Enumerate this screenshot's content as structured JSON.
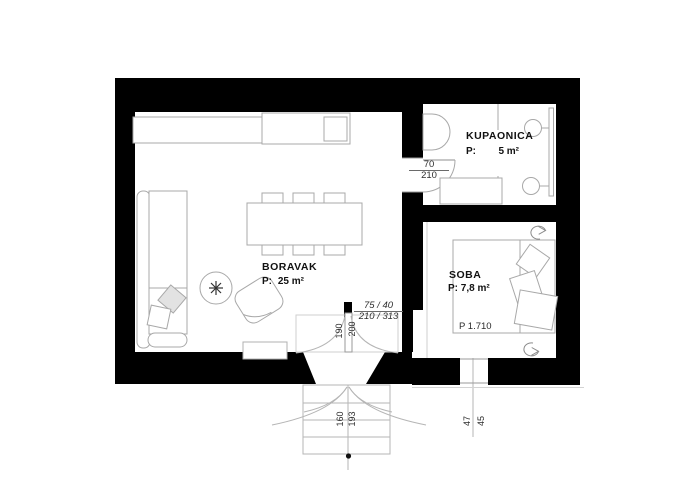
{
  "rooms": {
    "boravak": {
      "name": "BORAVAK",
      "p": "P:",
      "area": "25 m²"
    },
    "kupaonica": {
      "name": "KUPAONICA",
      "p": "P:",
      "area": "5 m²"
    },
    "soba": {
      "name": "SOBA",
      "area_line": "P: 7,8 m²",
      "bed_note": "P 1.710"
    }
  },
  "dims": {
    "bath_door": {
      "top": "70",
      "bottom": "210"
    },
    "entry": {
      "top": "75 / 40",
      "bottom": "210 / 313"
    },
    "door_leaves": {
      "left": "190",
      "right": "200"
    },
    "porch": {
      "left": "160",
      "right": "193"
    },
    "window": {
      "left": "47",
      "right": "45"
    }
  },
  "colors": {
    "wall": "#000000",
    "furniture_line": "#a8a8a8",
    "text": "#1a1a1a"
  }
}
